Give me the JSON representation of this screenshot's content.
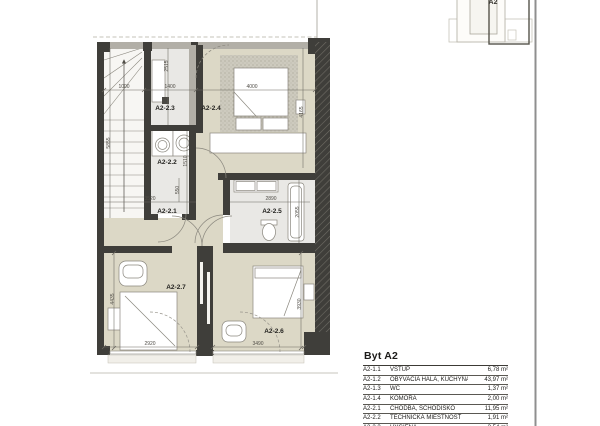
{
  "inset": {
    "label": "A2"
  },
  "plan": {
    "rooms": [
      {
        "label": "A2-2.3",
        "x": 165,
        "y": 110
      },
      {
        "label": "A2-2.4",
        "x": 211,
        "y": 110
      },
      {
        "label": "A2-2.2",
        "x": 167,
        "y": 164
      },
      {
        "label": "A2-2.1",
        "x": 167,
        "y": 213
      },
      {
        "label": "A2-2.5",
        "x": 272,
        "y": 213
      },
      {
        "label": "A2-2.7",
        "x": 176,
        "y": 289
      },
      {
        "label": "A2-2.6",
        "x": 274,
        "y": 333
      }
    ],
    "dimensions": [
      {
        "value": "1000",
        "x": 124,
        "y": 88,
        "rot": 0
      },
      {
        "value": "1400",
        "x": 170,
        "y": 88,
        "rot": 0
      },
      {
        "value": "4000",
        "x": 252,
        "y": 88,
        "rot": 0
      },
      {
        "value": "2515",
        "x": 168,
        "y": 66,
        "rot": -90
      },
      {
        "value": "5855",
        "x": 110,
        "y": 143,
        "rot": -90
      },
      {
        "value": "4165",
        "x": 303,
        "y": 112,
        "rot": -90
      },
      {
        "value": "1510",
        "x": 187,
        "y": 161,
        "rot": -90
      },
      {
        "value": "550",
        "x": 179,
        "y": 190,
        "rot": -90
      },
      {
        "value": "3520",
        "x": 150,
        "y": 200,
        "rot": 0
      },
      {
        "value": "2890",
        "x": 271,
        "y": 200,
        "rot": 0
      },
      {
        "value": "2055",
        "x": 299,
        "y": 212,
        "rot": -90
      },
      {
        "value": "4435",
        "x": 114,
        "y": 299,
        "rot": -90
      },
      {
        "value": "3930",
        "x": 301,
        "y": 304,
        "rot": -90
      },
      {
        "value": "2920",
        "x": 150,
        "y": 345,
        "rot": 0
      },
      {
        "value": "3490",
        "x": 258,
        "y": 345,
        "rot": 0
      }
    ]
  },
  "legend": {
    "title": "Byt A2",
    "rows": [
      {
        "code": "A2-1.1",
        "name": "VSTUP",
        "area": "6,78 m²"
      },
      {
        "code": "A2-1.2",
        "name": "OBÝVACIA HALA, KUCHYŇA",
        "area": "43,97 m²"
      },
      {
        "code": "A2-1.3",
        "name": "WC",
        "area": "1,37 m²"
      },
      {
        "code": "A2-1.4",
        "name": "KOMORA",
        "area": "2,00 m²"
      },
      {
        "code": "A2-2.1",
        "name": "CHODBA, SCHODISKO",
        "area": "11,95 m²"
      },
      {
        "code": "A2-2.2",
        "name": "TECHNICKÁ MIESTNOSŤ",
        "area": "1,91 m²"
      },
      {
        "code": "A2-2.3",
        "name": "HYGIENA",
        "area": "3,54 m²"
      }
    ]
  },
  "colors": {
    "wall": "#3f3e3a",
    "floor_beige": "#dcd8c6",
    "floor_gray": "#e9e8e5",
    "line": "#6b6860"
  }
}
